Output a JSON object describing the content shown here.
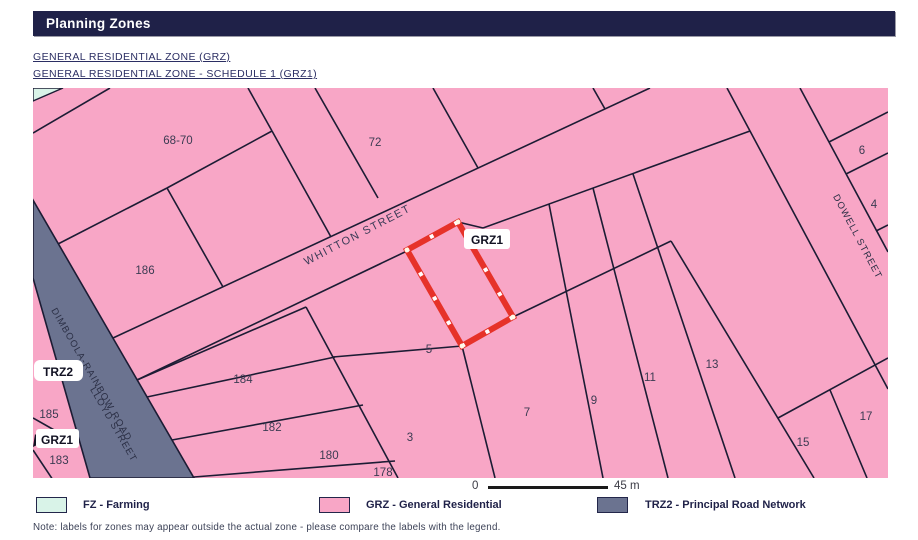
{
  "header": {
    "title": "Planning Zones"
  },
  "links": [
    {
      "label": "GENERAL RESIDENTIAL ZONE (GRZ)"
    },
    {
      "label": "GENERAL RESIDENTIAL ZONE - SCHEDULE 1 (GRZ1)"
    }
  ],
  "map": {
    "streets": {
      "whitton": "WHITTON STREET",
      "dowell": "DOWELL STREET",
      "dimboola": "DIMBOOLA-RAINBOW ROAD",
      "lloyd": "LLOYD STREET"
    },
    "lots": {
      "l6870": "68-70",
      "l72": "72",
      "l186": "186",
      "l184": "184",
      "l182": "182",
      "l180": "180",
      "l178": "178",
      "l3": "3",
      "l5": "5",
      "l7": "7",
      "l9": "9",
      "l11": "11",
      "l13": "13",
      "l15": "15",
      "l17": "17",
      "l6": "6",
      "l4": "4",
      "l185": "185",
      "l183": "183"
    },
    "annotations": {
      "grz1_parcel": "GRZ1",
      "trz2_road": "TRZ2",
      "grz1_left": "GRZ1"
    },
    "scalebar": {
      "start": "0",
      "end": "45 m"
    },
    "colors": {
      "residential": "#f8a6c6",
      "road": "#6b7390",
      "farming": "#d9f3e8",
      "highlight": "#e63229",
      "parcel_line": "#1c1c34"
    }
  },
  "legend": {
    "items": [
      {
        "code": "FZ",
        "label": "FZ - Farming",
        "color": "#d9f3e8"
      },
      {
        "code": "GRZ",
        "label": "GRZ - General Residential",
        "color": "#f8a6c6"
      },
      {
        "code": "TRZ2",
        "label": "TRZ2 - Principal Road Network",
        "color": "#6b7390"
      }
    ]
  },
  "note": "Note: labels for zones may appear outside the actual zone - please compare the labels with the legend."
}
